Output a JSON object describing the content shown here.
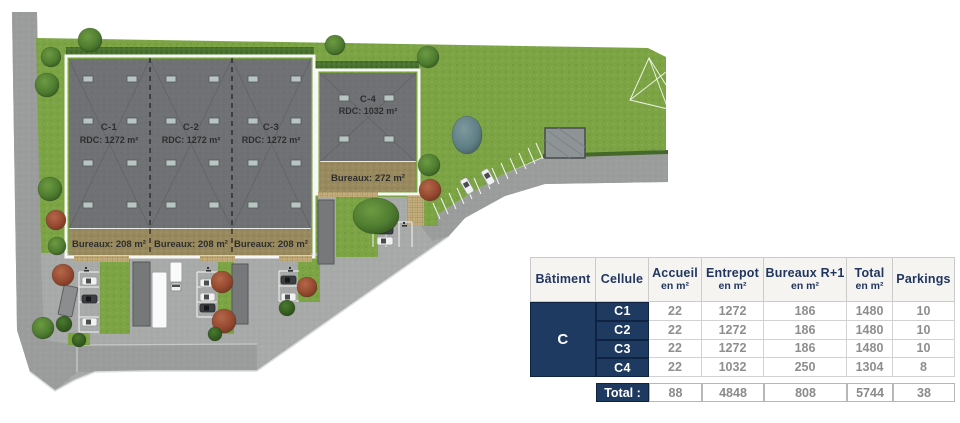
{
  "site": {
    "building_main": {
      "cells": [
        {
          "name": "C-1",
          "rdc": "RDC: 1272 m²",
          "bureaux": "Bureaux: 208 m²"
        },
        {
          "name": "C-2",
          "rdc": "RDC: 1272 m²",
          "bureaux": "Bureaux: 208 m²"
        },
        {
          "name": "C-3",
          "rdc": "RDC: 1272 m²",
          "bureaux": "Bureaux: 208 m²"
        }
      ]
    },
    "building_c4": {
      "name": "C-4",
      "rdc": "RDC: 1032 m²",
      "bureaux": "Bureaux: 272 m²"
    }
  },
  "table": {
    "headers": {
      "batiment": "Bâtiment",
      "cellule": "Cellule",
      "accueil": "Accueil",
      "entrepot": "Entrepot",
      "bureaux": "Bureaux R+1",
      "total": "Total",
      "parkings": "Parkings",
      "unit": "en m²"
    },
    "building_label": "C",
    "rows": [
      {
        "cellule": "C1",
        "accueil": "22",
        "entrepot": "1272",
        "bureaux": "186",
        "total": "1480",
        "parkings": "10"
      },
      {
        "cellule": "C2",
        "accueil": "22",
        "entrepot": "1272",
        "bureaux": "186",
        "total": "1480",
        "parkings": "10"
      },
      {
        "cellule": "C3",
        "accueil": "22",
        "entrepot": "1272",
        "bureaux": "186",
        "total": "1480",
        "parkings": "10"
      },
      {
        "cellule": "C4",
        "accueil": "22",
        "entrepot": "1032",
        "bureaux": "250",
        "total": "1304",
        "parkings": "8"
      }
    ],
    "total": {
      "label": "Total :",
      "accueil": "88",
      "entrepot": "4848",
      "bureaux": "808",
      "total": "5744",
      "parkings": "38"
    }
  },
  "colors": {
    "navy": "#1f3a60",
    "table_value_gray": "#8e8e8e",
    "grass_green": "#7ca445",
    "roof_gray": "#6f7174",
    "bureaux_tan": "#98895e",
    "asphalt": "#9c9e9d",
    "yard_concrete": "#a8aaa9"
  }
}
